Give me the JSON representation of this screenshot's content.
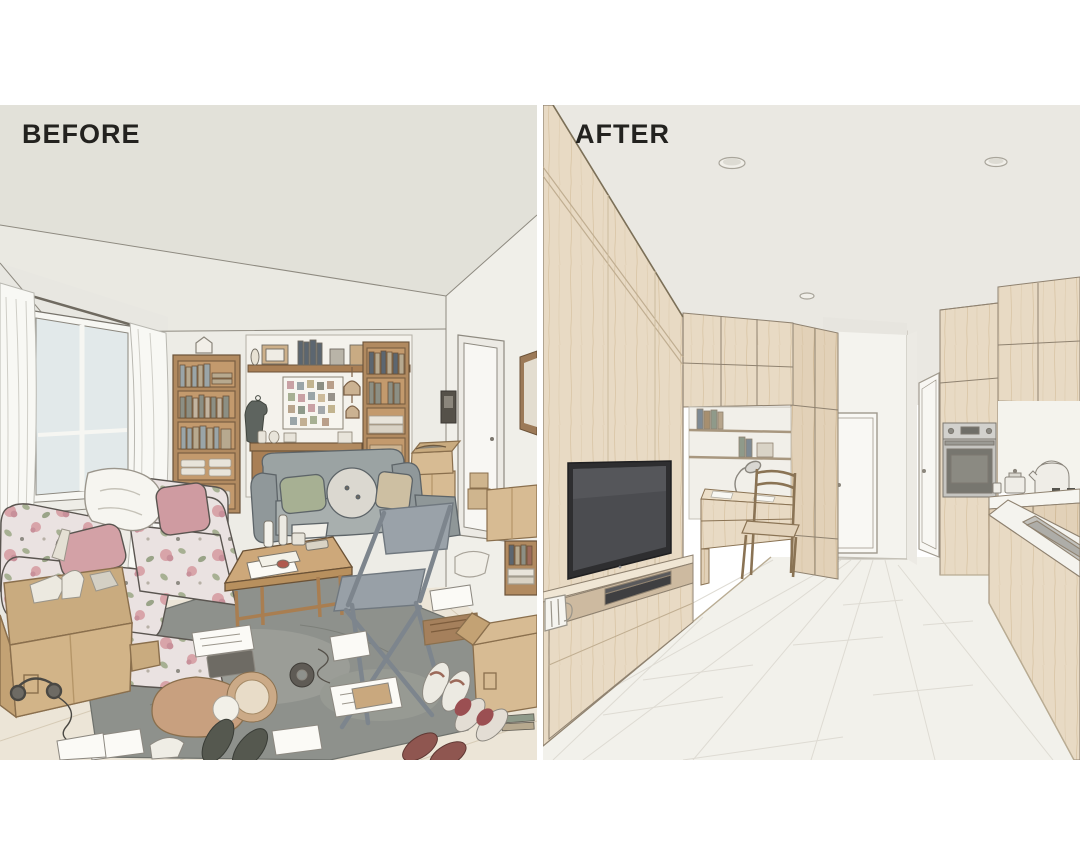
{
  "image": {
    "kind": "before-after interior renovation illustration",
    "panels": {
      "before": {
        "label": "BEFORE",
        "scene": "cluttered living room",
        "items": [
          "window with sheer curtains",
          "tall bookshelf",
          "photo memo board",
          "wall shelf with frames",
          "second bookshelf",
          "hanging birdcage ornaments",
          "grey loveseat with pillows",
          "floral sofa with white throw",
          "wooden coffee table",
          "metal folding chair",
          "grey rug",
          "open cardboard boxes",
          "scattered papers",
          "tote bag",
          "slippers and shoes",
          "open door to hallway",
          "intercom panel",
          "picture frame"
        ]
      },
      "after": {
        "label": "AFTER",
        "scene": "renovated minimalist apartment",
        "items": [
          "full-height wood cabinet wall",
          "wall-mounted tv",
          "media console with player",
          "white mug",
          "desk nook with shelves and books",
          "desk lamp",
          "wooden desk chair",
          "tall wardrobe column",
          "hallway with white doors",
          "recessed ceiling lights",
          "built-in oven",
          "built-in microwave",
          "kitchen counter with kettle and pot",
          "gas cooktop",
          "kitchen island with sink",
          "white plank floor"
        ]
      }
    },
    "palette": {
      "page_background": "#ffffff",
      "label_text": "#23221f",
      "before_ceiling": "#e2e1d9",
      "before_wall": "#edece6",
      "before_floor": "#ece5d7",
      "before_wood": "#b18a60",
      "before_rug": "#8e918c",
      "cardboard": "#d7bb93",
      "floral_pink": "#d8a4a9",
      "floral_sage": "#a7b093",
      "after_wood": "#e8dac4",
      "after_wall": "#f3f2ec",
      "after_floor": "#f2f1eb",
      "tv_screen": "#4b4c50",
      "oven_steel": "#c6c5c1"
    }
  }
}
